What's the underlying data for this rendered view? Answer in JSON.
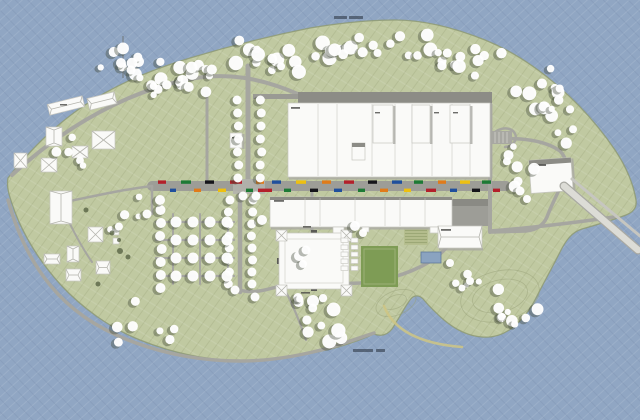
{
  "meta": {
    "description": "Architectural masterplan site plan of an elongated island surrounded by water: large white factory complex with north wings, a central retail street lined with small colored shop signs, a square courtyard building, tree orchard grid, scattered farm buildings, sports field, pool, ferry pier at the east tip and a curved sand jetty in the south water. Two tiny illegible gray text labels sit on the water (top-center and bottom-center).",
    "legible_text_present": false
  },
  "colors": {
    "water": "#90a6c3",
    "waterLineLight": "rgba(255,255,255,0.10)",
    "waterLineDark": "rgba(40,60,95,0.10)",
    "land": "#c0c9a1",
    "landLine": "rgba(100,110,65,0.13)",
    "landLine2": "rgba(255,255,255,0.10)",
    "shore": "#8e9a74",
    "road": "#a6a6a0",
    "street": "#9d9d97",
    "building": "#fafaf8",
    "buildingStroke": "#c6c6c0",
    "shadow": "#a9a9a3",
    "darkRoof": "#8c8c86",
    "ridge": "#b5b5ae",
    "tree": "#ffffff",
    "treeShadow": "#3f4636",
    "bush": "#4a5538",
    "field": "#7e9c55",
    "gardenBase": "#b6bf90",
    "gardenStripe": "#96a370",
    "pool": "#8aa3c0",
    "poolStroke": "#5f7a9a",
    "jetty": "#cfc584",
    "smudge": "#4a4a46",
    "waterLabel": "#2e3846",
    "contour": "#99a37a",
    "entrance": "#5a5a55"
  },
  "map": {
    "roads": [
      {
        "d": "M12,175 C70,122 130,92 185,80 C225,71 262,78 300,95",
        "w": 4
      },
      {
        "d": "M248,66 L248,182",
        "w": 5
      },
      {
        "d": "M207,90 L207,182",
        "w": 3
      },
      {
        "d": "M152,186 L506,186",
        "w": 10,
        "street": true
      },
      {
        "d": "M60,203 C95,196 120,190 152,186",
        "w": 2.5
      },
      {
        "d": "M240,193 L240,292",
        "w": 4.5
      },
      {
        "d": "M240,290 C252,294 266,290 280,286 L360,283 C386,281 406,274 422,266 C438,258 450,246 456,234",
        "w": 3.5
      },
      {
        "d": "M312,193 L312,233",
        "w": 3
      },
      {
        "d": "M490,100 L490,232",
        "w": 4
      },
      {
        "d": "M490,140 C520,136 546,141 560,151 C568,159 568,171 563,181 C558,193 551,206 547,217 C543,226 536,230 526,231 L492,232",
        "w": 3.5
      },
      {
        "d": "M490,231 C530,228 572,223 614,217",
        "w": 3.5
      },
      {
        "d": "M563,181 L572,186",
        "w": 2.5
      },
      {
        "d": "M8,200 C18,236 32,263 50,285 C72,312 102,331 136,343 C172,356 206,361 240,361 C272,361 304,355 332,347 C348,342 362,337 374,333",
        "w": 3.5
      },
      {
        "d": "M152,186 L152,214",
        "w": 2.5
      },
      {
        "d": "M156,222 L234,222",
        "w": 2.2
      },
      {
        "d": "M156,240 L234,240",
        "w": 2.2
      },
      {
        "d": "M156,258 L234,258",
        "w": 2.2
      },
      {
        "d": "M156,276 L234,276",
        "w": 2.2
      },
      {
        "d": "M173,214 L173,284",
        "w": 2
      },
      {
        "d": "M200,214 L200,284",
        "w": 2
      },
      {
        "d": "M228,214 L228,284",
        "w": 2
      },
      {
        "d": "M283,286 C293,305 300,322 306,340",
        "w": 2.2
      },
      {
        "d": "M490,141 C491,130 506,125 513,131 C519,137 515,146 505,147",
        "w": 2.5
      },
      {
        "d": "M60,203 C70,225 80,245 92,262",
        "w": 2
      }
    ],
    "flats": [
      {
        "x": 298,
        "y": 92,
        "w": 194,
        "h": 11,
        "f": "darkRoof"
      },
      {
        "x": 253,
        "y": 94,
        "w": 45,
        "h": 5,
        "f": "#9a9a94"
      },
      {
        "x": 233,
        "y": 179,
        "w": 32,
        "h": 15,
        "f": "#b2b2ac",
        "o": 0.9
      },
      {
        "x": 452,
        "y": 199,
        "w": 36,
        "h": 27,
        "f": "#9d9d97"
      },
      {
        "x": 452,
        "y": 199,
        "w": 36,
        "h": 7,
        "f": "#8a8a84"
      },
      {
        "x": 337,
        "y": 110,
        "w": 33,
        "h": 31,
        "f": "#90908a"
      },
      {
        "x": 292,
        "y": 245,
        "w": 44,
        "h": 32,
        "f": "#b5b5af"
      },
      {
        "x": 296,
        "y": 249,
        "w": 22,
        "h": 15,
        "f": "#aab486",
        "o": 0.7
      },
      {
        "x": 361,
        "y": 246,
        "w": 37,
        "h": 41,
        "f": "field"
      },
      {
        "x": 364,
        "y": 249,
        "w": 31,
        "h": 35,
        "f": "none",
        "s": "#9cb176",
        "sw": 1
      },
      {
        "x": 404,
        "y": 228,
        "w": 24,
        "h": 17,
        "f": "gardenBase",
        "stripes": 5
      },
      {
        "x": 421,
        "y": 252,
        "w": 20,
        "h": 11,
        "f": "pool",
        "s": "poolStroke",
        "sw": 0.8
      },
      {
        "x": 492,
        "y": 131,
        "w": 20,
        "h": 13,
        "f": "#a8a8a2",
        "stalls": 4
      },
      {
        "x": 556,
        "y": 179,
        "w": 14,
        "h": 10,
        "f": "#cfcfc9",
        "rot": 40
      },
      {
        "x": 311,
        "y": 230,
        "w": 6,
        "h": 3,
        "f": "entrance"
      },
      {
        "x": 311,
        "y": 288,
        "w": 6,
        "h": 3,
        "f": "entrance"
      },
      {
        "x": 277,
        "y": 258,
        "w": 3,
        "h": 6,
        "f": "entrance"
      },
      {
        "x": 344,
        "y": 258,
        "w": 3,
        "h": 6,
        "f": "entrance"
      }
    ],
    "buildings": [
      {
        "x": 288,
        "y": 103,
        "w": 202,
        "h": 74,
        "parts": [
          318,
          337,
          372,
          395,
          412,
          432,
          452,
          470
        ],
        "shR": 1,
        "shB": 1
      },
      {
        "x": 373,
        "y": 105,
        "w": 20,
        "h": 38,
        "shR": 1
      },
      {
        "x": 412,
        "y": 105,
        "w": 18,
        "h": 38,
        "shR": 1
      },
      {
        "x": 450,
        "y": 105,
        "w": 20,
        "h": 38,
        "shR": 1
      },
      {
        "x": 352,
        "y": 143,
        "w": 13,
        "h": 17,
        "darkTop": 4
      },
      {
        "x": 270,
        "y": 197,
        "w": 182,
        "h": 30,
        "darkTop": 3,
        "parts": [
          305,
          320,
          355,
          385,
          400,
          425
        ],
        "shB": 1
      },
      {
        "x": 333,
        "y": 227,
        "w": 11,
        "h": 8
      },
      {
        "x": 430,
        "y": 227,
        "w": 9,
        "h": 6
      },
      {
        "x": 362,
        "y": 227,
        "w": 7,
        "h": 5
      },
      {
        "x": 438,
        "y": 226,
        "w": 44,
        "h": 22,
        "ridge": "h",
        "shB": 1
      },
      {
        "x": 530,
        "y": 159,
        "w": 42,
        "h": 33,
        "rot": -4,
        "darkTop": 5,
        "shR": 1
      },
      {
        "x": 230,
        "y": 133,
        "w": 12,
        "h": 15,
        "shR": 1
      },
      {
        "x": 48,
        "y": 100,
        "w": 36,
        "h": 11,
        "rot": -14,
        "ridge": "h"
      },
      {
        "x": 88,
        "y": 95,
        "w": 28,
        "h": 12,
        "rot": -14,
        "ridge": "h"
      },
      {
        "x": 46,
        "y": 127,
        "w": 16,
        "h": 19,
        "ridge": "v"
      },
      {
        "x": 92,
        "y": 131,
        "w": 23,
        "h": 18,
        "ridge": "x"
      },
      {
        "x": 72,
        "y": 146,
        "w": 16,
        "h": 12,
        "ridge": "x"
      },
      {
        "x": 14,
        "y": 153,
        "w": 13,
        "h": 15,
        "ridge": "x"
      },
      {
        "x": 41,
        "y": 158,
        "w": 16,
        "h": 14,
        "ridge": "x"
      },
      {
        "x": 50,
        "y": 191,
        "w": 22,
        "h": 33,
        "ridge": "v"
      },
      {
        "x": 88,
        "y": 227,
        "w": 15,
        "h": 15,
        "ridge": "x"
      },
      {
        "x": 44,
        "y": 254,
        "w": 16,
        "h": 10,
        "ridge": "h"
      },
      {
        "x": 67,
        "y": 246,
        "w": 12,
        "h": 16,
        "ridge": "v"
      },
      {
        "x": 66,
        "y": 269,
        "w": 15,
        "h": 12,
        "ridge": "h"
      },
      {
        "x": 96,
        "y": 261,
        "w": 14,
        "h": 13,
        "ridge": "h"
      },
      {
        "x": 113,
        "y": 229,
        "w": 6,
        "h": 6
      },
      {
        "x": 113,
        "y": 238,
        "w": 6,
        "h": 6
      },
      {
        "x": 279,
        "y": 233,
        "w": 70,
        "h": 56,
        "ring": 1
      },
      {
        "x": 276,
        "y": 230,
        "w": 11,
        "h": 11,
        "ridge": "x"
      },
      {
        "x": 341,
        "y": 230,
        "w": 11,
        "h": 11,
        "ridge": "x"
      },
      {
        "x": 276,
        "y": 285,
        "w": 11,
        "h": 11,
        "ridge": "x"
      },
      {
        "x": 341,
        "y": 285,
        "w": 11,
        "h": 11,
        "ridge": "x"
      }
    ],
    "cabins": {
      "x0": 341,
      "y0": 238,
      "cols": 2,
      "rows": 5,
      "dx": 10,
      "dy": 7,
      "w": 7,
      "h": 4.5
    },
    "lines": [
      {
        "x1": 340,
        "y1": 113,
        "x2": 367,
        "y2": 137,
        "c": "#7a7a74",
        "w": 6
      },
      {
        "x1": 123,
        "y1": 36,
        "x2": 123,
        "y2": 78,
        "c": "#6a6a64",
        "w": 0.8
      },
      {
        "x1": 119,
        "y1": 44,
        "x2": 127,
        "y2": 44,
        "c": "#6a6a64",
        "w": 0.6
      },
      {
        "x1": 120,
        "y1": 52,
        "x2": 126,
        "y2": 52,
        "c": "#6a6a64",
        "w": 0.6
      }
    ],
    "shops": {
      "topY": 180.4,
      "botY": 188.6,
      "h": 3.4,
      "palette": [
        "#b3202a",
        "#1d7a35",
        "#e07b1a",
        "#1f4f9c",
        "#eec00f",
        "#15151a",
        "#6b1f7e",
        "#cfd0ca"
      ],
      "blocks": [
        [
          158,
          8,
          0,
          0
        ],
        [
          170,
          6,
          1,
          3
        ],
        [
          181,
          10,
          0,
          1
        ],
        [
          194,
          7,
          1,
          2
        ],
        [
          205,
          9,
          0,
          5
        ],
        [
          218,
          8,
          1,
          4
        ],
        [
          230,
          12,
          0,
          0
        ],
        [
          246,
          7,
          1,
          1
        ],
        [
          258,
          14,
          1,
          0
        ],
        [
          256,
          8,
          0,
          2
        ],
        [
          272,
          9,
          0,
          3
        ],
        [
          284,
          7,
          1,
          1
        ],
        [
          296,
          10,
          0,
          4
        ],
        [
          310,
          8,
          1,
          5
        ],
        [
          322,
          9,
          0,
          2
        ],
        [
          334,
          8,
          1,
          3
        ],
        [
          344,
          10,
          0,
          0
        ],
        [
          358,
          7,
          1,
          1
        ],
        [
          368,
          9,
          0,
          5
        ],
        [
          380,
          8,
          1,
          2
        ],
        [
          392,
          10,
          0,
          3
        ],
        [
          404,
          7,
          1,
          4
        ],
        [
          414,
          9,
          0,
          1
        ],
        [
          426,
          10,
          1,
          0
        ],
        [
          438,
          8,
          0,
          2
        ],
        [
          450,
          7,
          1,
          3
        ],
        [
          460,
          10,
          0,
          4
        ],
        [
          472,
          8,
          1,
          5
        ],
        [
          482,
          9,
          0,
          1
        ],
        [
          493,
          7,
          1,
          0
        ]
      ]
    },
    "smudges": [
      [
        291,
        107,
        9,
        1.8
      ],
      [
        274,
        200,
        10,
        1.8
      ],
      [
        534,
        164,
        12,
        2
      ],
      [
        441,
        229,
        10,
        1.8
      ],
      [
        303,
        226,
        8,
        1.6
      ],
      [
        301,
        292,
        9,
        1.6
      ],
      [
        232,
        137,
        7,
        1.5
      ],
      [
        60,
        104,
        7,
        1.5
      ],
      [
        375,
        112,
        5,
        1.4
      ],
      [
        434,
        112,
        5,
        1.4
      ],
      [
        453,
        112,
        5,
        1.4
      ]
    ],
    "waterLabels": [
      [
        334,
        16,
        13,
        3
      ],
      [
        349,
        16,
        14,
        3
      ],
      [
        353,
        349,
        20,
        3
      ],
      [
        376,
        349,
        9,
        3
      ]
    ],
    "contours": [
      {
        "cx": 500,
        "cy": 296,
        "rx": 40,
        "ry": 25,
        "rot": -14
      },
      {
        "cx": 500,
        "cy": 296,
        "rx": 28,
        "ry": 16,
        "rot": -14
      },
      {
        "cx": 396,
        "cy": 303,
        "rx": 21,
        "ry": 12,
        "rot": -22
      },
      {
        "cx": 395,
        "cy": 302,
        "rx": 12,
        "ry": 6.5,
        "rot": -22
      }
    ],
    "special": [
      {
        "d": "M564,186 L638,250",
        "w": 9,
        "c": "#a9a9a3"
      },
      {
        "d": "M564,186 L638,250",
        "w": 6.5,
        "c": "#dcdcd6"
      },
      {
        "d": "M572,179 L640,236",
        "w": 3,
        "c": "#c6c6c0"
      },
      {
        "d": "M384,306 Q398,342 462,347",
        "w": 2.6,
        "c": "jetty",
        "o": 0.85
      }
    ],
    "trees": {
      "clusters": [
        [
          135,
          60,
          95,
          30,
          14,
          3.5,
          7
        ],
        [
          228,
          40,
          102,
          32,
          16,
          3.5,
          7.5
        ],
        [
          330,
          30,
          100,
          28,
          15,
          3.5,
          7.5
        ],
        [
          428,
          42,
          82,
          34,
          13,
          3.5,
          7
        ],
        [
          506,
          66,
          60,
          50,
          12,
          3.5,
          7
        ],
        [
          543,
          103,
          32,
          42,
          6,
          3,
          6
        ],
        [
          140,
          76,
          92,
          20,
          9,
          3,
          6
        ],
        [
          96,
          46,
          48,
          26,
          6,
          3,
          6
        ],
        [
          506,
          143,
          42,
          46,
          7,
          3,
          6
        ],
        [
          22,
          118,
          62,
          62,
          5,
          2.5,
          5
        ],
        [
          88,
          168,
          58,
          70,
          5,
          2.5,
          5
        ],
        [
          92,
          298,
          92,
          46,
          7,
          3,
          6
        ],
        [
          293,
          296,
          58,
          50,
          13,
          3.5,
          7.5
        ],
        [
          492,
          286,
          46,
          40,
          9,
          3,
          6.5
        ],
        [
          452,
          270,
          28,
          20,
          4,
          2.5,
          4.5
        ]
      ],
      "rows": [
        [
          238,
          100,
          178,
          13,
          4.5
        ],
        [
          261,
          100,
          178,
          13,
          4.5
        ],
        [
          229,
          200,
          294,
          12,
          4.5
        ],
        [
          252,
          200,
          294,
          12,
          4.5
        ],
        [
          161,
          210,
          292,
          13,
          5
        ]
      ],
      "gridCols": [
        176,
        193,
        210,
        227
      ],
      "gridRows": [
        222,
        240,
        258,
        276
      ],
      "gridR": 5.5,
      "singles": [
        [
          299,
          256,
          5
        ],
        [
          306,
          250,
          4.5
        ],
        [
          303,
          264,
          4
        ],
        [
          262,
          220,
          5
        ],
        [
          355,
          226,
          5
        ],
        [
          363,
          233,
          4
        ],
        [
          450,
          263,
          4
        ],
        [
          470,
          281,
          4
        ],
        [
          462,
          288,
          3.5
        ],
        [
          520,
          191,
          4.5
        ],
        [
          527,
          199,
          4
        ],
        [
          243,
          196,
          4.5
        ],
        [
          256,
          196,
          4.5
        ],
        [
          160,
          200,
          5
        ],
        [
          147,
          214,
          4.5
        ],
        [
          235,
          290,
          4.5
        ],
        [
          255,
          297,
          4.5
        ],
        [
          121,
          63,
          5
        ],
        [
          131,
          70,
          4.5
        ]
      ],
      "bushes": [
        [
          120,
          251,
          3
        ],
        [
          128,
          257,
          2.5
        ],
        [
          112,
          233,
          2.5
        ],
        [
          119,
          240,
          2
        ],
        [
          86,
          210,
          2.5
        ],
        [
          98,
          284,
          2.5
        ]
      ]
    }
  }
}
